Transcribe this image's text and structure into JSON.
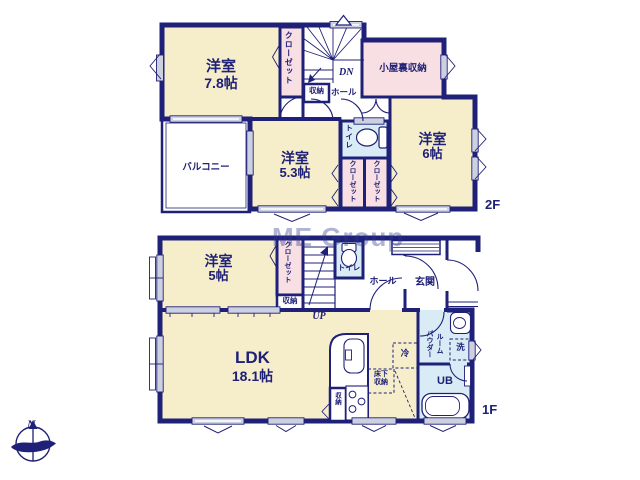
{
  "watermark": "ME Group",
  "compass": {
    "north_label": "N"
  },
  "floor_2f": {
    "floor_label": "2F",
    "bedroom_78": {
      "name": "洋室",
      "size": "7.8帖"
    },
    "closet": "クローゼット",
    "storage": "収納",
    "hall": "ホール",
    "stairs_direction": "DN",
    "attic_storage": "小屋裏収納",
    "balcony": "バルコニー",
    "bedroom_53": {
      "name": "洋室",
      "size": "5.3帖"
    },
    "toilet": "トイレ",
    "closet_a": "クローゼット",
    "closet_b": "クローゼット",
    "bedroom_6": {
      "name": "洋室",
      "size": "6帖"
    }
  },
  "floor_1f": {
    "floor_label": "1F",
    "bedroom_5": {
      "name": "洋室",
      "size": "5帖"
    },
    "closet": "クローゼット",
    "storage": "収納",
    "stairs_direction": "UP",
    "toilet": "トイレ",
    "hall": "ホール",
    "entrance": "玄関",
    "ldk": {
      "name": "LDK",
      "size": "18.1帖"
    },
    "kitchen_storage": "収納",
    "underfloor_storage": {
      "line1": "床下",
      "line2": "収納"
    },
    "refrigerator": "冷",
    "powder_room": {
      "line1": "パウダー",
      "line2": "ルーム"
    },
    "washer": "洗",
    "unit_bath": "UB"
  },
  "colors": {
    "wall": "#1f2077",
    "room_cream": "#f6eecb",
    "closet_pink": "#f8dfe3",
    "wet_blue": "#d9ecf5",
    "window_gray": "#cdd0e0"
  }
}
